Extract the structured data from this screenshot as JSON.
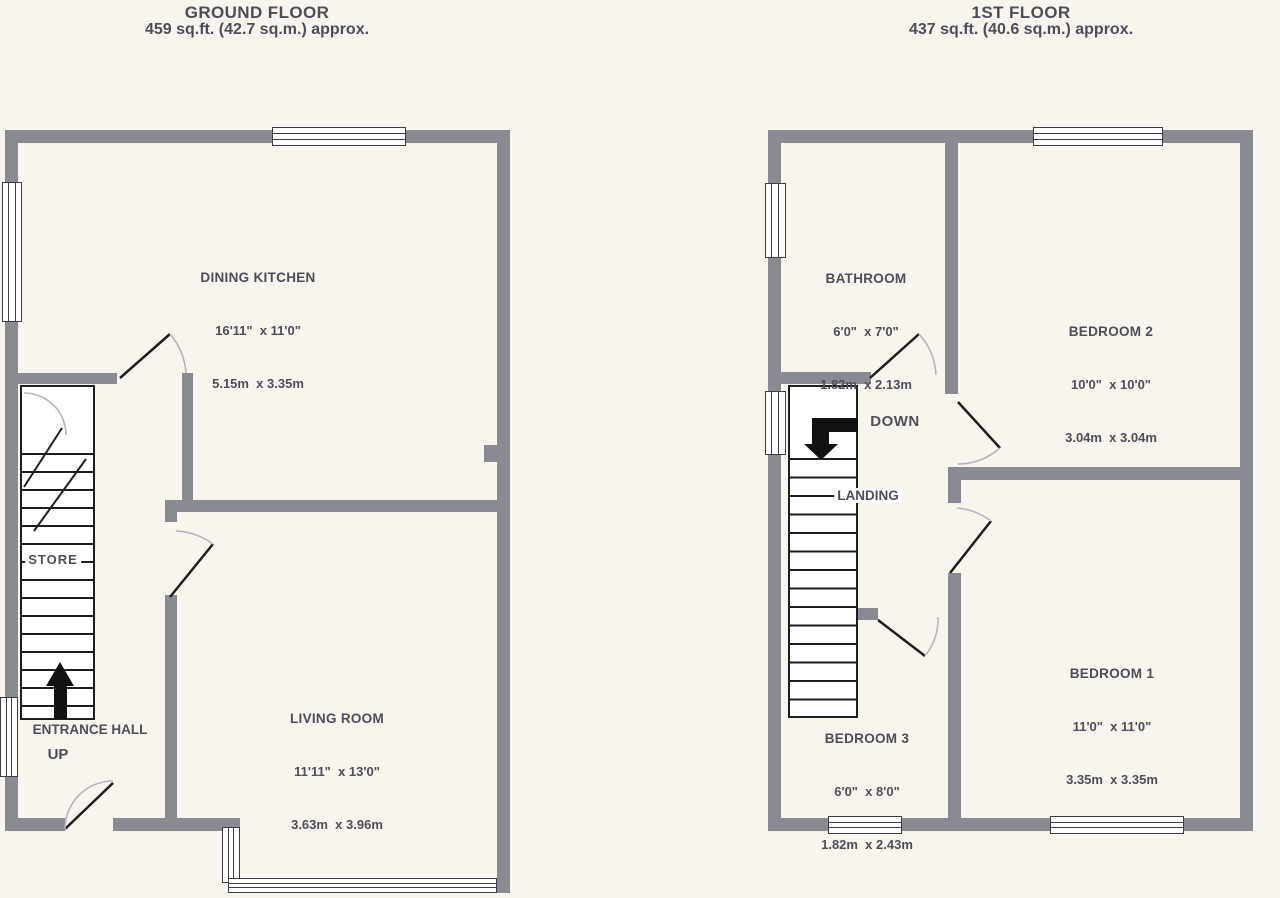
{
  "ground_floor": {
    "title": "GROUND FLOOR",
    "area": "459 sq.ft. (42.7 sq.m.) approx.",
    "dining_kitchen": {
      "name": "DINING KITCHEN",
      "imperial": "16'11\"  x 11'0\"",
      "metric": "5.15m  x 3.35m"
    },
    "living_room": {
      "name": "LIVING ROOM",
      "imperial": "11'11\"  x 13'0\"",
      "metric": "3.63m  x 3.96m"
    },
    "store_label": "STORE",
    "entrance_hall_label": "ENTRANCE HALL",
    "up_label": "UP"
  },
  "first_floor": {
    "title": "1ST FLOOR",
    "area": "437 sq.ft. (40.6 sq.m.) approx.",
    "bathroom": {
      "name": "BATHROOM",
      "imperial": "6'0\"  x 7'0\"",
      "metric": "1.82m  x 2.13m"
    },
    "bedroom_2": {
      "name": "BEDROOM 2",
      "imperial": "10'0\"  x 10'0\"",
      "metric": "3.04m  x 3.04m"
    },
    "bedroom_1": {
      "name": "BEDROOM 1",
      "imperial": "11'0\"  x 11'0\"",
      "metric": "3.35m  x 3.35m"
    },
    "bedroom_3": {
      "name": "BEDROOM 3",
      "imperial": "6'0\"  x 8'0\"",
      "metric": "1.82m  x 2.43m"
    },
    "landing_label": "LANDING",
    "down_label": "DOWN"
  },
  "colors": {
    "wall": "#8a8a92",
    "background": "#f8f5ef",
    "text": "#4e4e58",
    "line": "#1e1e1e",
    "arc": "#b6b4bd"
  }
}
